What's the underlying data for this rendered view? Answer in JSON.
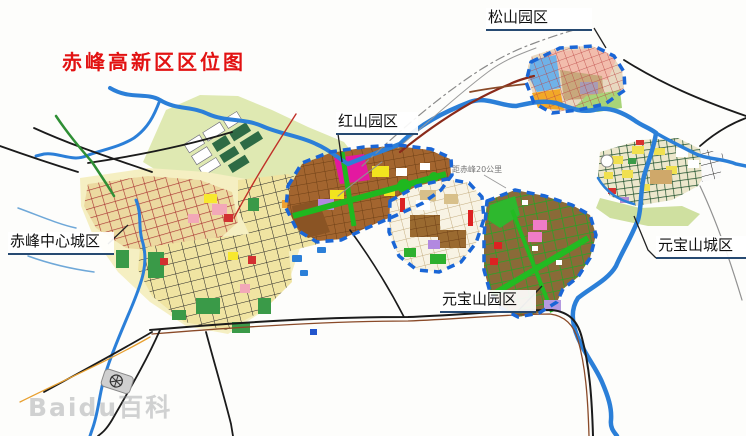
{
  "title": {
    "text": "赤峰高新区区位图",
    "color": "#e21212"
  },
  "callouts": {
    "songshan": {
      "label": "松山园区"
    },
    "hongshan": {
      "label": "红山园区"
    },
    "chifeng_center": {
      "label": "赤峰中心城区"
    },
    "yuanbaoshan_park": {
      "label": "元宝山园区"
    },
    "yuanbaoshan_city": {
      "label": "元宝山城区"
    }
  },
  "annotation": {
    "text": "距赤峰20公里"
  },
  "watermark": {
    "text": "Baidu百科"
  },
  "map": {
    "type": "planning-location-map",
    "regions": [
      "松山园区",
      "红山园区",
      "赤峰中心城区",
      "元宝山园区",
      "元宝山城区"
    ],
    "colors": {
      "river": "#2b7fd8",
      "park_boundary_dashed": "#1a66d6",
      "hongshan_fill": "#a3652f",
      "yuanbaoshan_fill": "#8a6a38",
      "city_block_yellow": "#f0e4a2",
      "green_space": "#3a9a48",
      "highway_red": "#8a2a1a",
      "road_black": "#1b1b1b",
      "olive_terrain": "#dfe9b2",
      "title_red": "#e21212"
    }
  }
}
